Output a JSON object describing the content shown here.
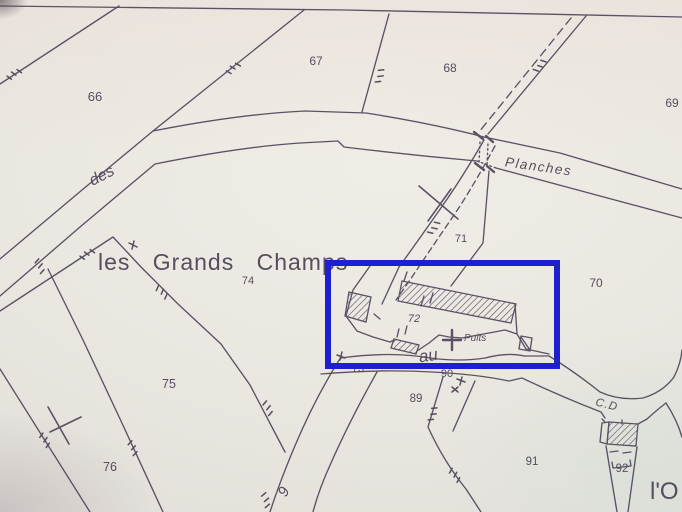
{
  "map_type": "cadastral-plan-photo",
  "colors": {
    "paper": "#eae7e1",
    "ink": "#50455a",
    "highlight": "#1f1fd2"
  },
  "parcels": {
    "p66": "66",
    "p67": "67",
    "p68": "68",
    "p69": "69",
    "p70": "70",
    "p71": "71",
    "p72": "72",
    "p73": "73",
    "p74": "74",
    "p75": "75",
    "p76": "76",
    "p89": "89",
    "p90": "90",
    "p91": "91",
    "p92": "92"
  },
  "labels": {
    "road_des": "des",
    "road_planches": "Planches",
    "lieu_dit": "les Grands Champs",
    "road_au": "au",
    "well": "Puits",
    "road_cd": "C.D",
    "lieu_dit_partial": "l'O",
    "road_number": "9"
  },
  "highlight_box": {
    "note": "blue annotation rectangle around farm buildings and well"
  }
}
